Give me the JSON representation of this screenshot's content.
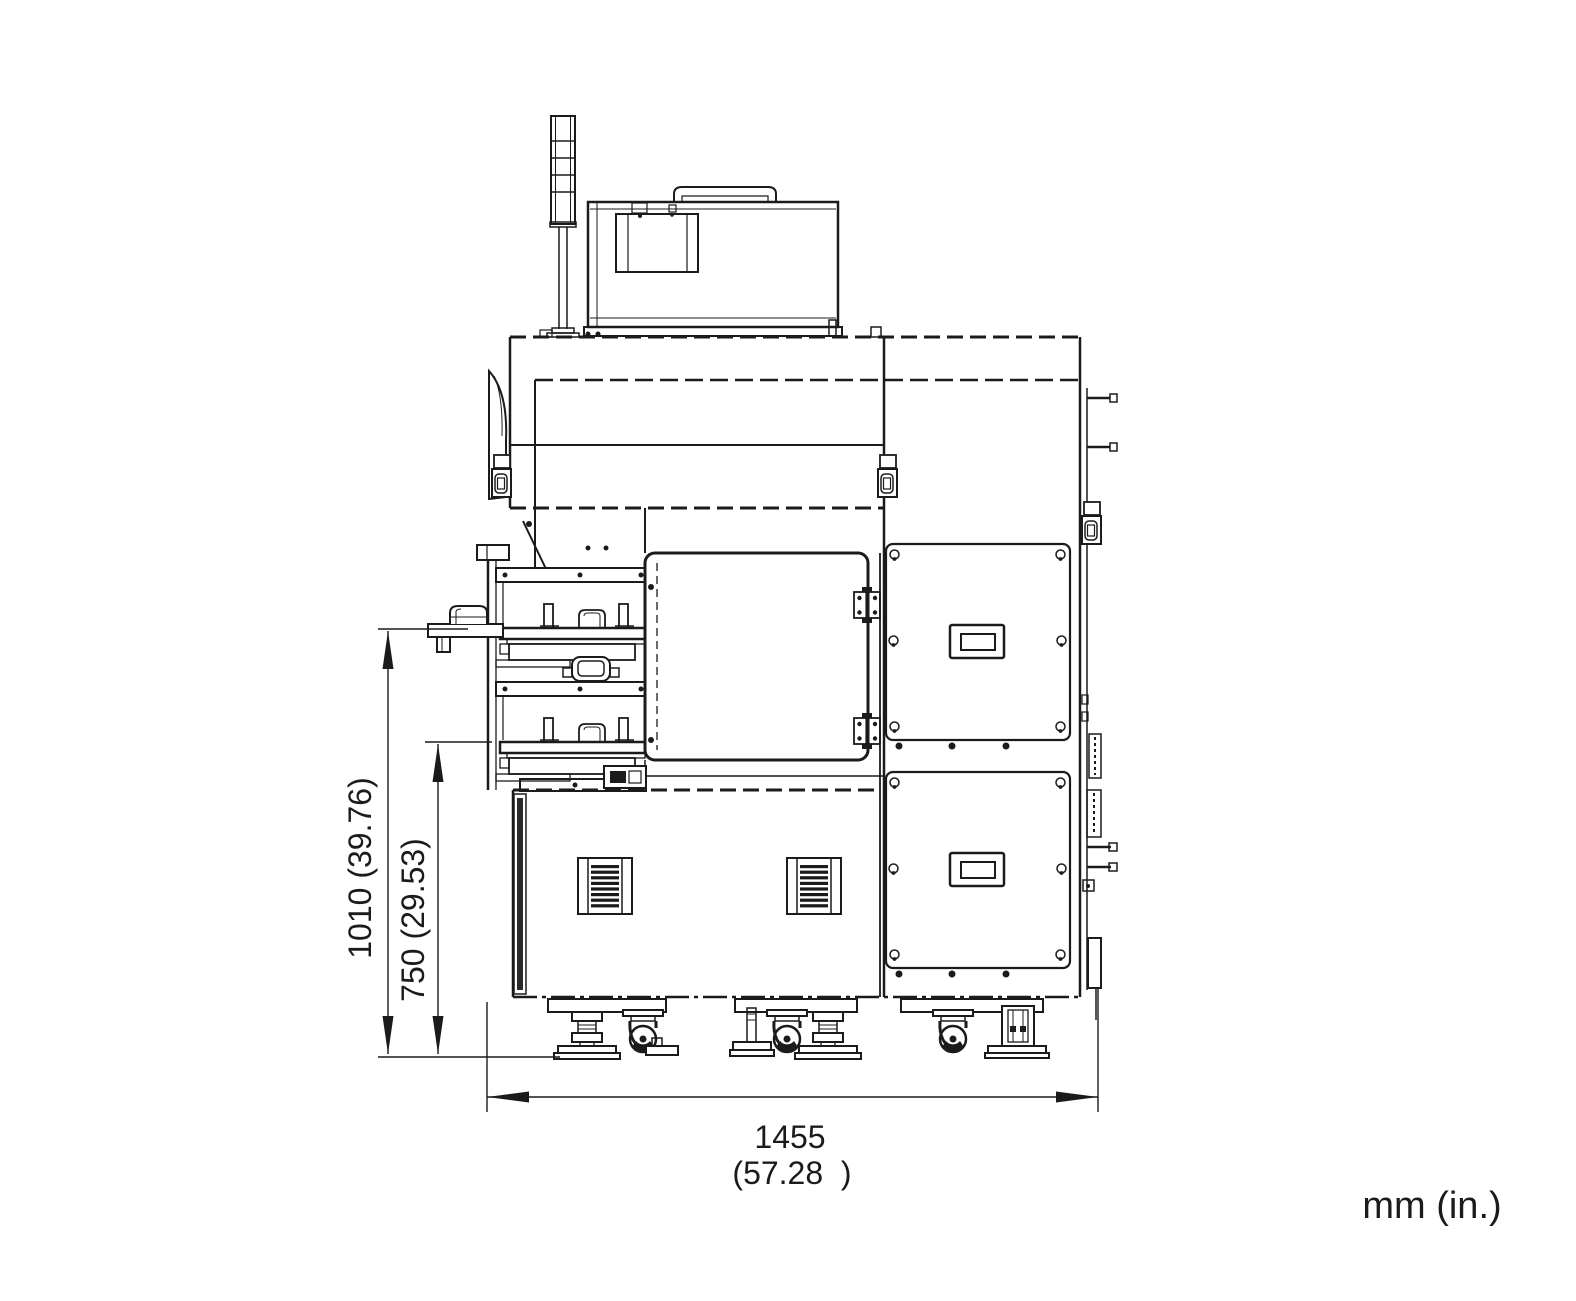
{
  "drawing": {
    "units_note": "mm (in.)",
    "dimensions": {
      "overall_height": {
        "label": "1010 (39.76)",
        "value_mm": "1010",
        "value_in": "39.76",
        "orientation": "vertical"
      },
      "load_port_height": {
        "label": "750 (29.53)",
        "value_mm": "750",
        "value_in": "29.53",
        "orientation": "vertical"
      },
      "overall_width": {
        "label_mm": "1455",
        "label_in": "(57.28  )",
        "value_mm": "1455",
        "value_in": "57.28",
        "orientation": "horizontal"
      }
    },
    "line_color": "#1b1b1b",
    "background_color": "#ffffff",
    "components": [
      "signal-tower",
      "top-enclosure",
      "carry-handle",
      "display-panel",
      "front-door",
      "door-hinge",
      "load-port-stage-1",
      "load-port-stage-2",
      "side-shelf",
      "louver-vent",
      "access-panel-upper",
      "access-panel-lower",
      "recessed-handle",
      "caster",
      "leveling-foot"
    ]
  }
}
